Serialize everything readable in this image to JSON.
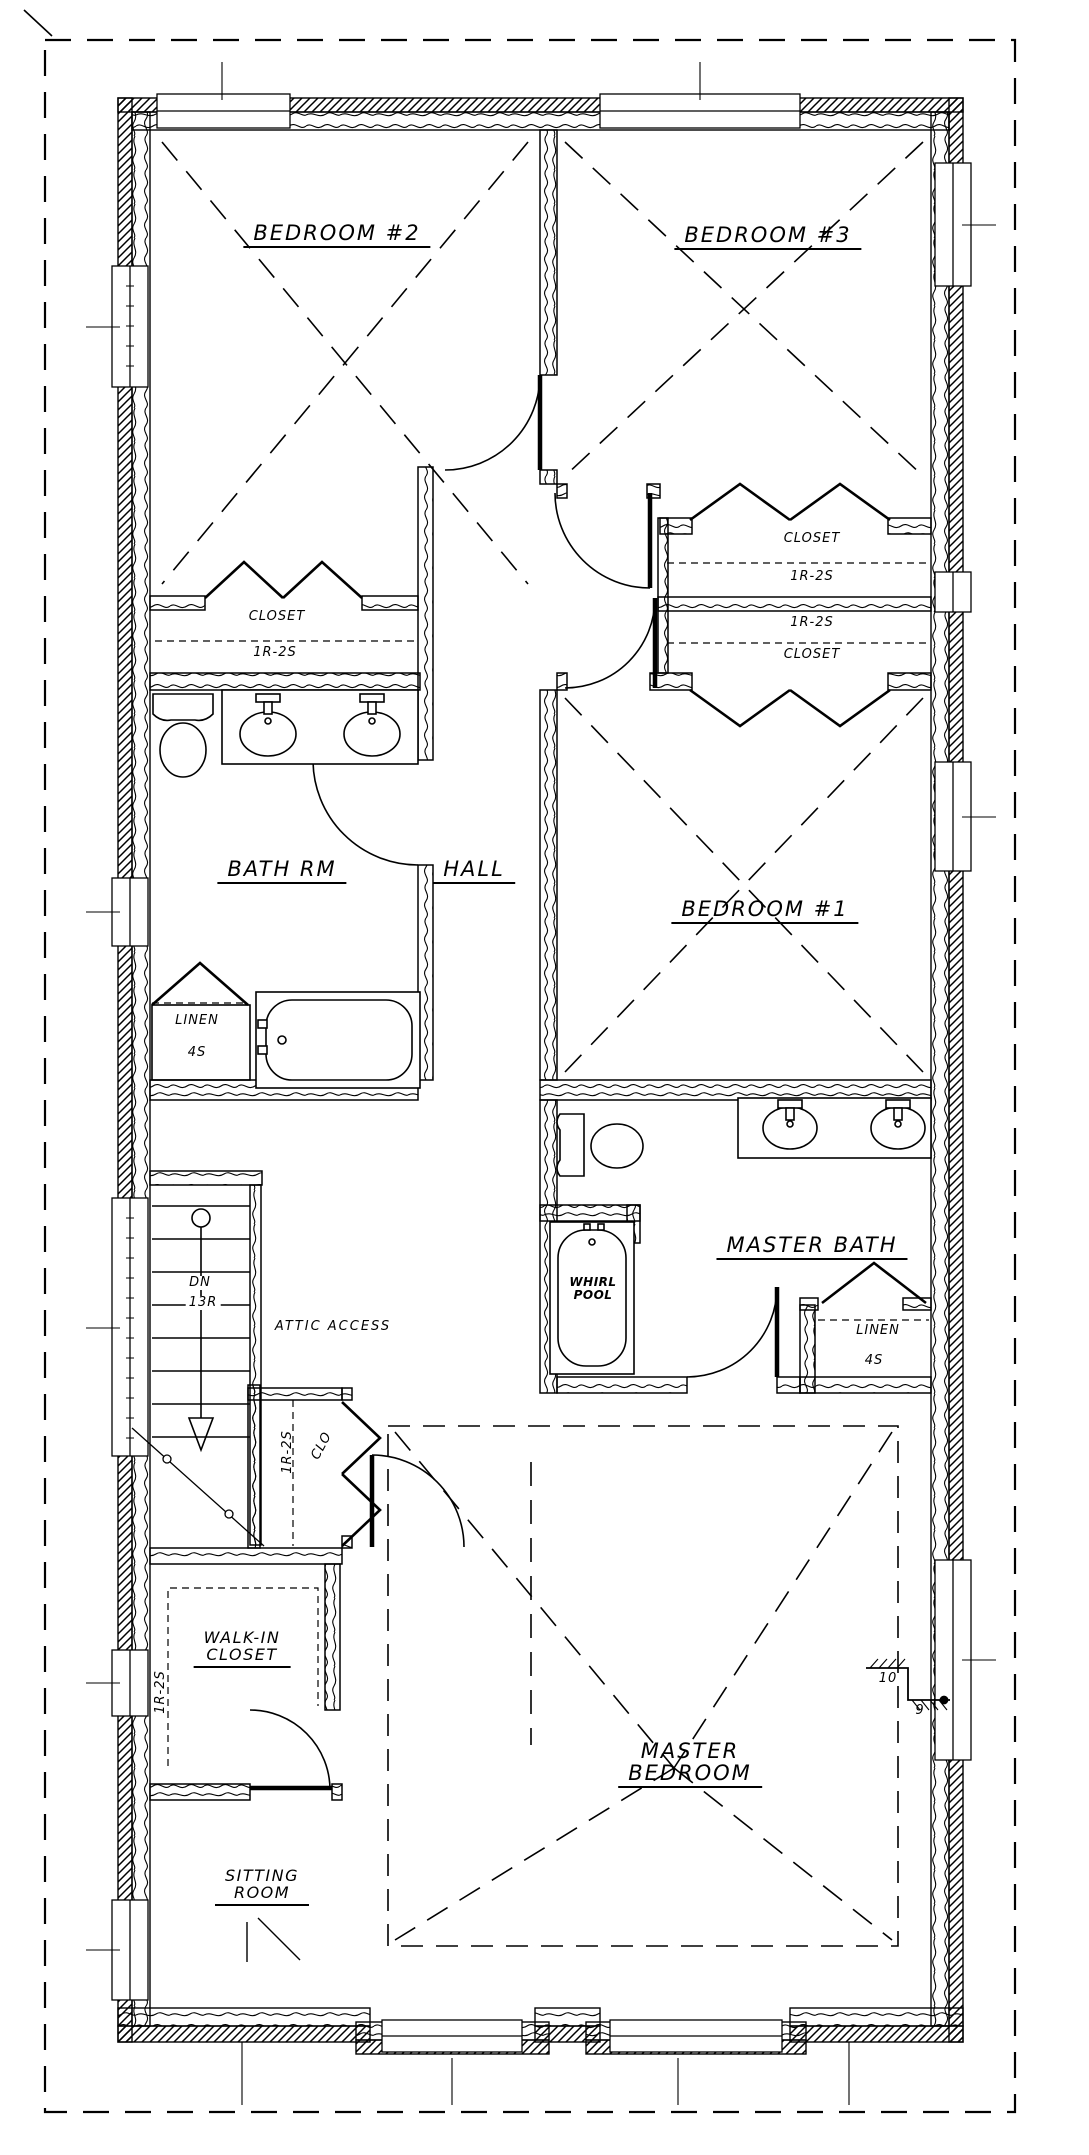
{
  "rooms": {
    "bedroom2": "BEDROOM #2",
    "bedroom3": "BEDROOM #3",
    "bedroom1": "BEDROOM #1",
    "bath_rm": "BATH RM",
    "hall": "HALL",
    "master_bath": "MASTER BATH",
    "master_bedroom_line1": "MASTER",
    "master_bedroom_line2": "BEDROOM",
    "sitting_line1": "SITTING",
    "sitting_line2": "ROOM",
    "walk_in_line1": "WALK-IN",
    "walk_in_line2": "CLOSET"
  },
  "closets": {
    "bedroom2_closet": {
      "name": "CLOSET",
      "config": "1R-2S"
    },
    "bedroom3_closet": {
      "name": "CLOSET",
      "config": "1R-2S"
    },
    "bedroom1_closet": {
      "name": "CLOSET",
      "config": "1R-2S"
    },
    "hall_linen": {
      "name": "LINEN",
      "config": "4S"
    },
    "master_linen": {
      "name": "LINEN",
      "config": "4S"
    },
    "hall_closet": {
      "name": "CLO",
      "config": "1R-2S"
    },
    "walk_in_closet": {
      "config": "1R-2S"
    }
  },
  "stairs": {
    "direction": "DN",
    "risers": "13R"
  },
  "fixtures": {
    "whirlpool_line1": "WHIRL",
    "whirlpool_line2": "POOL"
  },
  "annotations": {
    "attic_access": "ATTIC ACCESS",
    "ceiling_height_high": "10",
    "ceiling_height_low": "9"
  },
  "colors": {
    "line": "#000000",
    "background": "#ffffff"
  }
}
